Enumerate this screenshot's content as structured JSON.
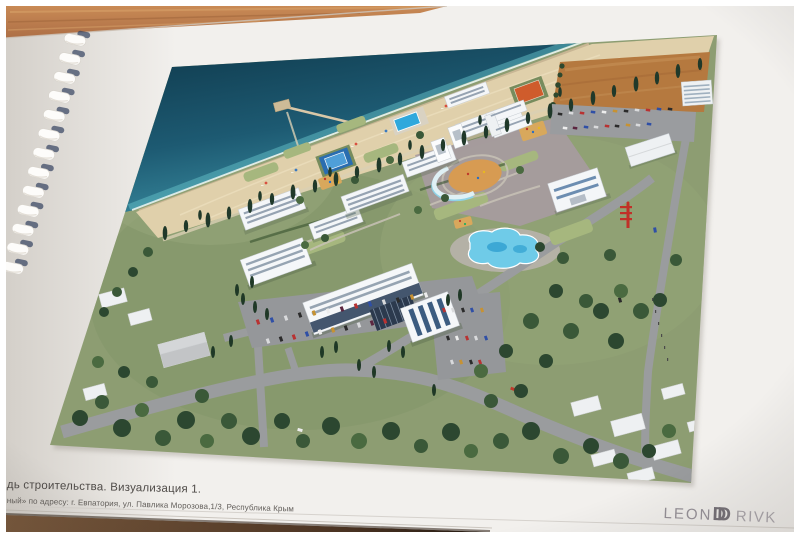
{
  "photo": {
    "subject": "aerial 3D visualization of seaside resort complex printed in a comb-bound album on wooden table",
    "colors": {
      "page": "#f2f0ed",
      "wood_table": "#c08252",
      "wood_shadow": "#3a2a1d",
      "sea_deep": "#12455c",
      "sea_shallow": "#57b3bc",
      "sand": "#e0d0ab",
      "dirt_lot": "#b5793f",
      "lawn": "#a6b77e",
      "tree_green": "#3a5838",
      "road": "#96989a",
      "building_white": "#f4f6f8",
      "glass_blue": "#44566e",
      "pool_blue": "#6fcbe8",
      "plaza": "#a79ba1",
      "accent_red": "#c13028"
    }
  },
  "caption": {
    "line1": "дь строительства. Визуализация 1.",
    "line2": "ный» по адресу: г. Евпатория, ул. Павлика Морозова,1/3, Республика Крым"
  },
  "logo": {
    "part1": "LEON",
    "mono1": "D",
    "mono2": "D",
    "part2": "RIVK"
  }
}
